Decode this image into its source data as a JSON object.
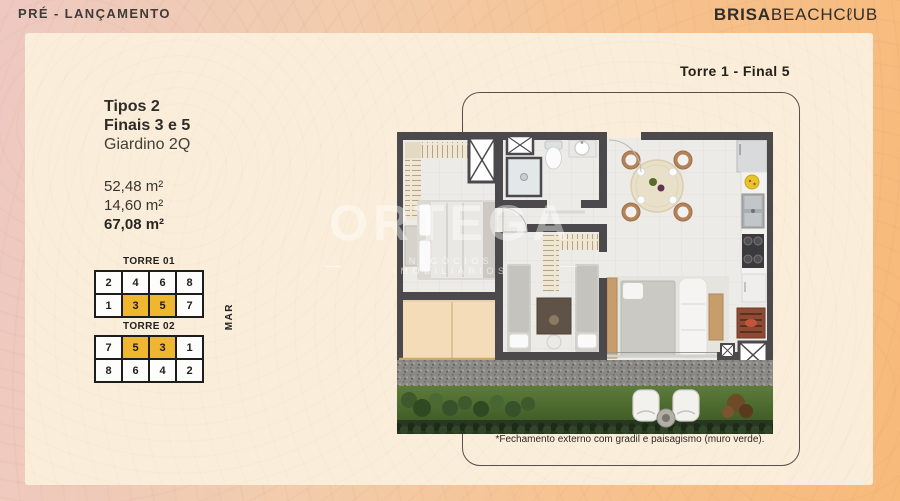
{
  "header": {
    "pre_launch": "PRÉ - LANÇAMENTO",
    "brand_bold": "BRISA",
    "brand_light": "BEACHCℓUB"
  },
  "unit": {
    "label": "Torre 1  - Final 5",
    "types": "Tipos 2",
    "finals": "Finais 3 e 5",
    "plan_type": "Giardino 2Q",
    "area_private": "52,48 m²",
    "area_garden": "14,60 m²",
    "area_total": "67,08 m²"
  },
  "towers": [
    {
      "title": "TORRE 01",
      "rows": [
        [
          "2",
          "4",
          "6",
          "8"
        ],
        [
          "1",
          "3",
          "5",
          "7"
        ]
      ],
      "highlighted_units": [
        "3",
        "5"
      ]
    },
    {
      "title": "TORRE 02",
      "rows": [
        [
          "7",
          "5",
          "3",
          "1"
        ],
        [
          "8",
          "6",
          "4",
          "2"
        ]
      ],
      "highlighted_units": [
        "5",
        "3"
      ]
    }
  ],
  "sea_label": "MAR",
  "watermark": {
    "title": "ORTEGA",
    "subtitle": "NEGÓCIOS IMOBILIÁRIOS"
  },
  "footnote": "*Fechamento externo com gradil e paisagismo (muro verde).",
  "colors": {
    "background_left": "#eec9c2",
    "background_right": "#f7ba79",
    "panel": "#faeedb",
    "unit_highlight": "#efb62f",
    "plan_wall": "#4b494b",
    "garden_green": "#4d6b33",
    "patio_beige": "#f4dcb8"
  }
}
